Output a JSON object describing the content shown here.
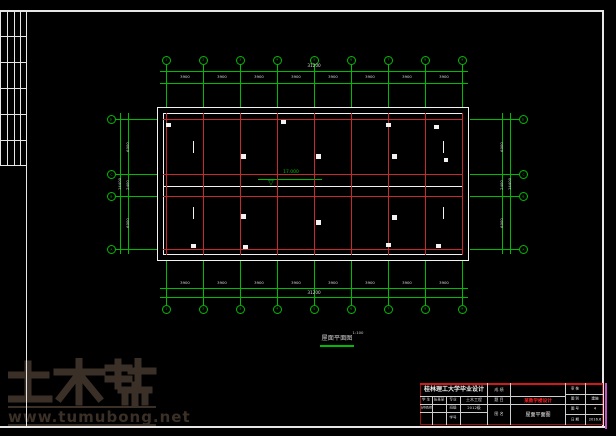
{
  "colors": {
    "background": "#000000",
    "frame": "#e6e6e6",
    "grid_green": "#00bc00",
    "grid_red": "#c52b2b",
    "wall_white": "#f2f2f2",
    "dim_text": "#d9d9d9",
    "titleblock_border": "#a01212",
    "subject_red": "#ff2222",
    "magenta_edge": "#c455c4",
    "watermark": "#3a3027"
  },
  "plan": {
    "title": "屋面平面图",
    "title_scale": "1:100",
    "elevation": "17.000"
  },
  "axes": {
    "vertical": [
      "1",
      "2",
      "3",
      "4",
      "5",
      "6",
      "7",
      "8",
      "9"
    ],
    "horizontal": [
      "D",
      "C",
      "B",
      "A"
    ]
  },
  "dimensions": {
    "top_spans": [
      "3900",
      "3900",
      "3900",
      "3900",
      "3900",
      "3900",
      "3900",
      "3900"
    ],
    "top_total": "31200",
    "bottom_spans": [
      "3900",
      "3900",
      "3900",
      "3900",
      "3900",
      "3900",
      "3900",
      "3900"
    ],
    "bottom_total": "31200",
    "side_spans": [
      "6000",
      "2400",
      "6000"
    ],
    "side_total": "14400"
  },
  "titleblock": {
    "university": "桂林理工大学毕业设计",
    "score_label": "成 绩",
    "student_label": "学 生",
    "student_name": "张某某",
    "major_label": "专业",
    "major_value": "土木工程",
    "advisor_label": "指导教师",
    "class_label": "班级",
    "class_value": "2012级",
    "id_label": "学号",
    "subject_label": "题 目",
    "subject_value": "某教学楼设计",
    "drawing_label": "图 名",
    "drawing_value": "屋面平面图",
    "right_rows": [
      {
        "label": "审 核",
        "value": ""
      },
      {
        "label": "图 别",
        "value": "建施"
      },
      {
        "label": "图 号",
        "value": "4"
      },
      {
        "label": "日 期",
        "value": "2016.6"
      }
    ]
  },
  "watermark": {
    "brand": "土木帮",
    "url": "www.tumubong.net"
  }
}
